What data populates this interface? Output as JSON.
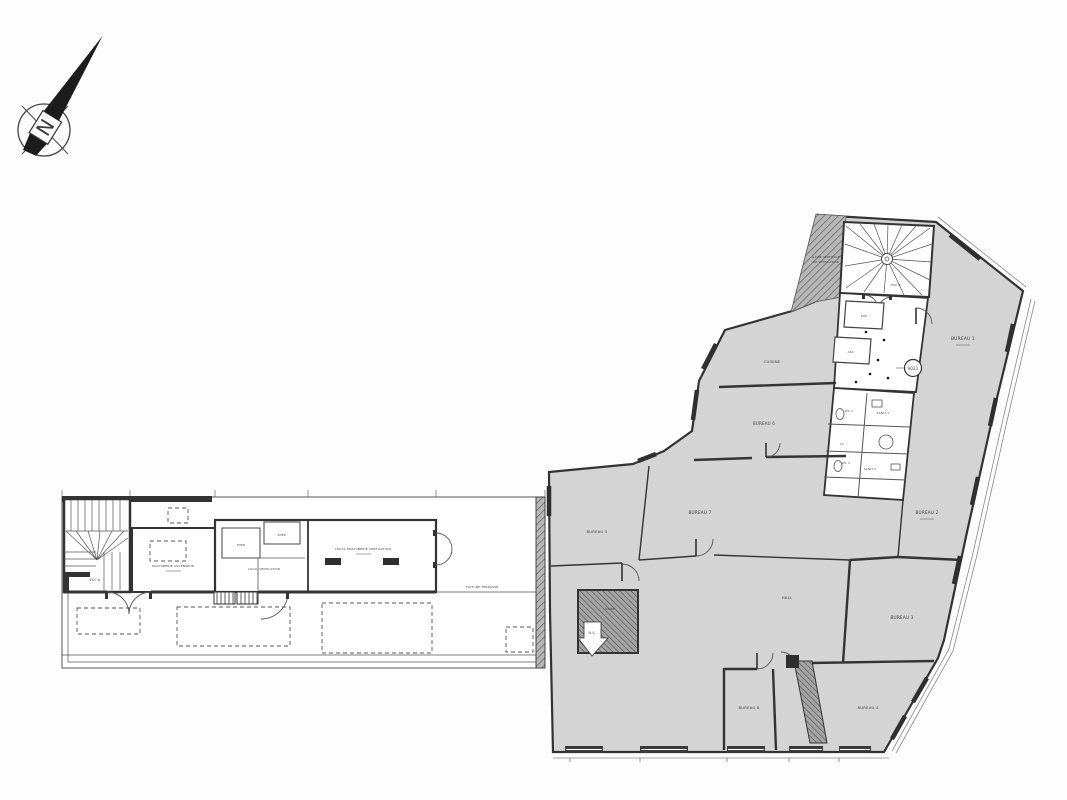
{
  "compass": {
    "letter": "N"
  },
  "colors": {
    "paper": "#fdfdfd",
    "ink": "#3a3a3a",
    "room_fill": "#d4d4d4",
    "hatch": "#8a8a8a"
  },
  "left_building": {
    "labels": {
      "esc_a": "ESC A",
      "machinerie_ascenseur": "MACHINERIE ASCENSEUR",
      "shed_1": "SHED",
      "shed_2": "SHED",
      "local_ventilation": "LOCAL VENTILATION",
      "local_machinerie_ventilation": "LOCAL MACHINERIE VENTILATION",
      "toiture_terrasse": "TOITURE TERRASSE"
    }
  },
  "right_building": {
    "badge": "9021",
    "labels": {
      "gaine_vent_1": "GAINE VERTICALE",
      "gaine_vent_2": "DE VENTILATION",
      "esc_b": "ESC B",
      "sas": "SAS",
      "asc": "ASC",
      "bureau_1": "BUREAU 1",
      "bureau_2": "BUREAU 2",
      "bureau_3": "BUREAU 3",
      "bureau_4": "BUREAU 4",
      "bureau_5": "BUREAU 5",
      "bureau_6": "BUREAU 6",
      "bureau_7": "BUREAU 7",
      "bureau_8": "BUREAU 8",
      "cuisine": "CUISINE",
      "hall": "HALL",
      "wc_1": "WC 1",
      "sanit_1": "SANIT 1",
      "lv": "LV",
      "wc_2": "WC 2",
      "sanit_2": "SANIT 2",
      "gaine": "GAINE",
      "nv": "N.V."
    }
  }
}
